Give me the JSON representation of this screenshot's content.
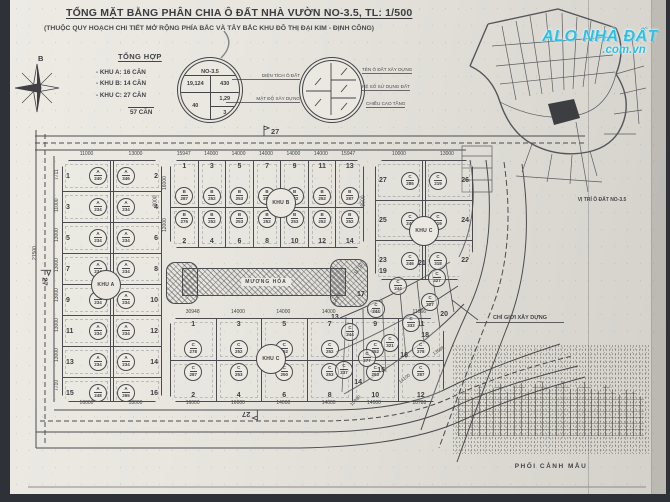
{
  "title": {
    "main": "TỔNG MẶT BẰNG PHÂN CHIA Ô ĐẤT NHÀ VƯỜN NO-3.5, TL: 1/500",
    "sub": "(THUỘC QUY HOẠCH CHI TIẾT MỞ RỘNG PHÍA BẮC VÀ TÂY BẮC KHU ĐÔ THỊ ĐẠI KIM - ĐỊNH CÔNG)"
  },
  "compass": {
    "north_label": "B"
  },
  "summary": {
    "heading": "TỔNG HỢP",
    "items": [
      "- KHU A: 16 CĂN",
      "- KHU B: 14 CĂN",
      "- KHU C: 27 CĂN"
    ],
    "total": "57 CĂN"
  },
  "info_circle": {
    "name": "NO-3.5",
    "area": "19,124",
    "build_area": "430",
    "density": "40",
    "coefficient": "1,29",
    "floors": "3"
  },
  "legend_circle": {
    "left_labels": [
      "DIỆN TÍCH Ô ĐẤT",
      "MẬT ĐỘ XÂY DỰNG"
    ],
    "right_labels": [
      "TÊN Ô ĐẤT XÂY DỰNG",
      "HỆ SỐ SỬ DỤNG ĐẤT",
      "CHIỀU CAO TẦNG"
    ]
  },
  "watermark": {
    "line1": "ALO NHÀ ĐẤT",
    "line2": ".com.vn",
    "color": "#2cc0e3"
  },
  "inset": {
    "caption": "VỊ TRÍ Ô ĐẤT NO-3.5"
  },
  "canal": {
    "label": "MƯƠNG HÓA"
  },
  "road": {
    "marker": "27",
    "left_dim": "21500",
    "lane_a_dim": "8000",
    "lane_c_dim": "8500"
  },
  "annotations": {
    "build_line": "CHỈ GIỚI XÂY DỰNG",
    "perspective_caption": "PHỐI CẢNH MẪU"
  },
  "blocks": {
    "khu_a": {
      "label": "KHU A",
      "top_dims": [
        "11000",
        "13000"
      ],
      "left_dims": [
        "7711",
        "11000",
        "13000",
        "13000",
        "13000",
        "13000",
        "13000",
        "7710"
      ],
      "bottom_dims": [
        "16000",
        "18000"
      ],
      "rows": [
        [
          {
            "n": "1",
            "t": "A",
            "v": "240"
          },
          {
            "n": "2",
            "t": "A",
            "v": "346"
          }
        ],
        [
          {
            "n": "3",
            "t": "A",
            "v": "234"
          },
          {
            "n": "4",
            "t": "A",
            "v": "234"
          }
        ],
        [
          {
            "n": "5",
            "t": "A",
            "v": "234"
          },
          {
            "n": "6",
            "t": "A",
            "v": "234"
          }
        ],
        [
          {
            "n": "7",
            "t": "A",
            "v": "234"
          },
          {
            "n": "8",
            "t": "A",
            "v": "234"
          }
        ],
        [
          {
            "n": "9",
            "t": "A",
            "v": "234"
          },
          {
            "n": "10",
            "t": "A",
            "v": "234"
          }
        ],
        [
          {
            "n": "11",
            "t": "A",
            "v": "234"
          },
          {
            "n": "12",
            "t": "A",
            "v": "234"
          }
        ],
        [
          {
            "n": "13",
            "t": "A",
            "v": "234"
          },
          {
            "n": "14",
            "t": "A",
            "v": "234"
          }
        ],
        [
          {
            "n": "15",
            "t": "A",
            "v": "248"
          },
          {
            "n": "16",
            "t": "A",
            "v": "265"
          }
        ]
      ]
    },
    "khu_b": {
      "label": "KHU B",
      "top_dims": [
        "15947",
        "14000",
        "14000",
        "14000",
        "14000",
        "14000",
        "15947"
      ],
      "left_dims": [
        "16000",
        "12000"
      ],
      "top_row": [
        {
          "n": "1",
          "t": "B",
          "v": "287"
        },
        {
          "n": "3",
          "t": "B",
          "v": "252"
        },
        {
          "n": "5",
          "t": "B",
          "v": "253"
        },
        {
          "n": "7",
          "t": "B",
          "v": "252"
        },
        {
          "n": "9",
          "t": "B",
          "v": "252"
        },
        {
          "n": "11",
          "t": "B",
          "v": "252"
        },
        {
          "n": "13",
          "t": "B",
          "v": "287"
        }
      ],
      "bottom_row": [
        {
          "n": "2",
          "t": "B",
          "v": "276"
        },
        {
          "n": "4",
          "t": "B",
          "v": "252"
        },
        {
          "n": "6",
          "t": "B",
          "v": "253"
        },
        {
          "n": "8",
          "t": "B",
          "v": "252"
        },
        {
          "n": "10",
          "t": "B",
          "v": "253"
        },
        {
          "n": "12",
          "t": "B",
          "v": "252"
        },
        {
          "n": "14",
          "t": "B",
          "v": "252"
        }
      ]
    },
    "khu_c_upper": {
      "label": "KHU C",
      "top_dims": [
        "10000",
        "13000"
      ],
      "rows": [
        [
          {
            "n": "27",
            "t": "C",
            "v": "285"
          },
          {
            "n": "26",
            "t": "C",
            "v": "219"
          }
        ],
        [
          {
            "n": "25",
            "t": "C",
            "v": "249"
          },
          {
            "n": "24",
            "t": "C",
            "v": "219"
          }
        ],
        [
          {
            "n": "23",
            "t": "C",
            "v": "246"
          },
          {
            "n": "22",
            "t": "C",
            "v": "318"
          }
        ]
      ]
    },
    "khu_c_main": {
      "label": "KHU C",
      "top_dims": [
        "30948",
        "14000",
        "14000",
        "14000",
        "14000",
        "11966"
      ],
      "bottom_dims": [
        "16000",
        "16000",
        "14000",
        "14000",
        "14000",
        "10788"
      ],
      "top_row": [
        {
          "n": "1",
          "t": "C",
          "v": "278"
        },
        {
          "n": "3",
          "t": "C",
          "v": "252"
        },
        {
          "n": "5",
          "t": "C",
          "v": "252"
        },
        {
          "n": "7",
          "t": "C",
          "v": "252"
        },
        {
          "n": "9",
          "t": "C",
          "v": "252"
        },
        {
          "n": "11",
          "t": "C",
          "v": "278"
        }
      ],
      "bottom_row": [
        {
          "n": "2",
          "t": "C",
          "v": "287"
        },
        {
          "n": "4",
          "t": "C",
          "v": "253"
        },
        {
          "n": "6",
          "t": "C",
          "v": "250"
        },
        {
          "n": "8",
          "t": "C",
          "v": "253"
        },
        {
          "n": "10",
          "t": "C",
          "v": "253"
        },
        {
          "n": "12",
          "t": "C",
          "v": "287"
        }
      ]
    },
    "khu_c_fan": {
      "inner": [
        {
          "n": "13",
          "t": "C",
          "v": "244"
        },
        {
          "n": "17",
          "t": "C",
          "v": "244"
        },
        {
          "n": "19",
          "t": "C",
          "v": "244"
        },
        {
          "n": "21",
          "t": "C",
          "v": "327"
        }
      ],
      "outer": [
        {
          "n": "14",
          "t": "C",
          "v": "237"
        },
        {
          "n": "15",
          "t": "C",
          "v": "277"
        },
        {
          "n": "16",
          "t": "C",
          "v": "321"
        },
        {
          "n": "18",
          "t": "C",
          "v": "332"
        },
        {
          "n": "20",
          "t": "C",
          "v": "227"
        }
      ],
      "dims": [
        "12089",
        "11712",
        "10980",
        "14100",
        "13586"
      ]
    }
  }
}
